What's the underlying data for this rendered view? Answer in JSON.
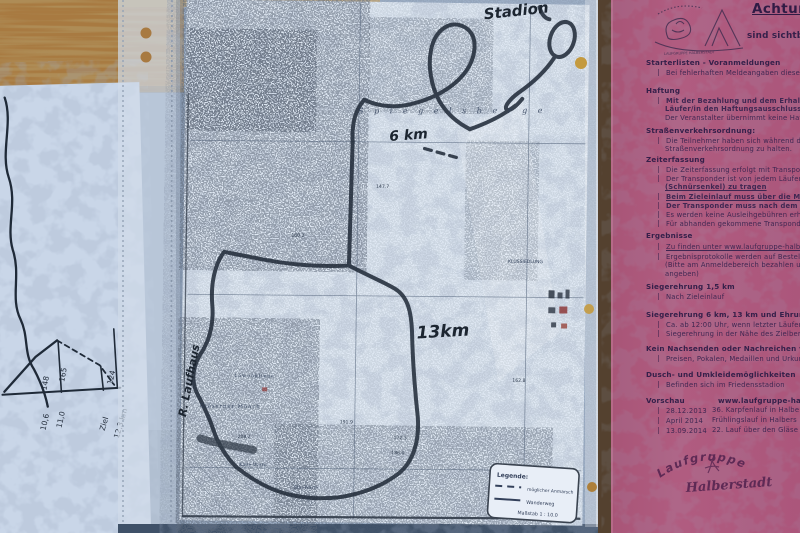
{
  "colors": {
    "pink_paper": "#b05c80",
    "pink_ink": "#3f2752",
    "map_paper": "#dfe8f3",
    "route_ink": "#232d3b",
    "wood": "#a87a41"
  },
  "left_sheet": {
    "elevation_labels": [
      "148",
      "165",
      "124"
    ],
    "distance_labels": [
      "10,6",
      "11,0",
      "Ziel",
      "12,3 km"
    ]
  },
  "map": {
    "handwritten": {
      "start": "Stadion",
      "short_course": "6 km",
      "long_course": "13km",
      "road": "R. Laufhaus"
    },
    "places": {
      "ridge": "S p i e g e l s b e r g e",
      "settlement": "KLUSSIEDLUNG",
      "moench": "Gläserner Mönch",
      "kliene": "Löwenkliene",
      "kalte_warte": "Kalte Warte",
      "stie_warte": "Stie-Warte"
    },
    "spot_heights": [
      "160.2",
      "147.7",
      "162.8",
      "208.2",
      "191.9",
      "172.3",
      "186.0"
    ],
    "legend": {
      "title": "Legende:",
      "dashed": "möglicher Anmarsch",
      "solid": "Wanderweg",
      "scale": "Maßstab 1 : 10.0"
    }
  },
  "pink_sheet": {
    "title": "Achtung",
    "visibility_note": "sind sichtbar",
    "sections": [
      {
        "heading": "Starterlisten - Voranmeldungen",
        "lines": [
          "Bei fehlerhaften Meldeangaben diese im A"
        ]
      },
      {
        "heading": "Haftung",
        "lines": [
          "Mit der Bezahlung und dem Erhalt der St",
          "Läufer/in den Haftungsausschluss an.",
          "Der Veranstalter übernimmt keine Haftung,"
        ]
      },
      {
        "heading": "Straßenverkehrsordnung:",
        "lines": [
          "Die Teilnehmer haben sich während des Lau",
          "Straßenverkehrsordnung zu halten."
        ]
      },
      {
        "heading": "Zeiterfassung",
        "lines": [
          "Die Zeiterfassung erfolgt mit Transponder",
          "Der Transponder ist von jedem Läufer/in a",
          "(Schnürsenkel) zu tragen",
          "Beim Zieleinlauf muss über die Messm",
          "Der Transponder muss nach dem Lauf",
          "Es werden keine Ausleihgebühren erhoben",
          "Für abhanden gekommene Transponder"
        ]
      },
      {
        "heading": "Ergebnisse",
        "lines": [
          "Zu finden unter www.laufgruppe-halbe",
          "Ergebnisprotokolle werden auf Bestellung",
          "(Bitte am Anmeldebereich bezahlen und",
          "angeben)"
        ]
      },
      {
        "heading": "Siegerehrung 1,5 km",
        "lines": [
          "Nach Zieleinlauf"
        ]
      },
      {
        "heading": "Siegerehrung 6 km, 13 km und Ehrung",
        "lines": [
          "Ca. ab 12:00 Uhr, wenn letzter Läufer/",
          "Siegerehrung in der Nähe des Zielberei"
        ]
      },
      {
        "heading": "Kein Nachsenden oder Nachreichen vo",
        "lines": [
          "Preisen, Pokalen, Medaillen und Urkund"
        ]
      },
      {
        "heading": "Dusch- und Umkleidemöglichkeiten",
        "lines": [
          "Befinden sich im Friedensstadion"
        ]
      },
      {
        "heading": "Vorschau",
        "heading_right": "www.laufgruppe-halber",
        "rows": [
          {
            "date": "28.12.2013",
            "event": "36. Karpfenlauf in Halbe"
          },
          {
            "date": "April 2014",
            "event": "Frühlingslauf in Halbers"
          },
          {
            "date": "13.09.2014",
            "event": "22. Lauf über den Gläse"
          }
        ]
      }
    ],
    "stamp": {
      "arc": "Laufgruppe",
      "name": "Halberstadt"
    },
    "header_stamp": {
      "bottom": "LAUFGRUPPE HALBERSTADT"
    }
  }
}
